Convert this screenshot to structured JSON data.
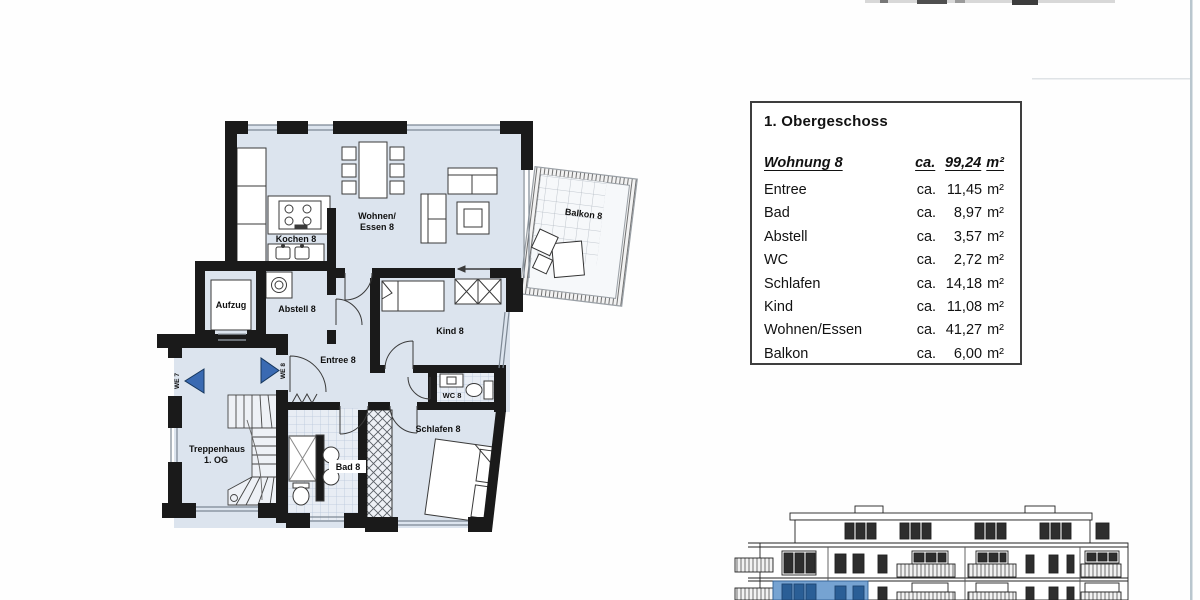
{
  "area_table": {
    "title": "1. Obergeschoss",
    "summary": {
      "label": "Wohnung 8",
      "prefix": "ca.",
      "value": "99,24",
      "unit": "m²"
    },
    "rows": [
      {
        "label": "Entree",
        "prefix": "ca.",
        "value": "11,45",
        "unit": "m²"
      },
      {
        "label": "Bad",
        "prefix": "ca.",
        "value": "8,97",
        "unit": "m²"
      },
      {
        "label": "Abstell",
        "prefix": "ca.",
        "value": "3,57",
        "unit": "m²"
      },
      {
        "label": "WC",
        "prefix": "ca.",
        "value": "2,72",
        "unit": "m²"
      },
      {
        "label": "Schlafen",
        "prefix": "ca.",
        "value": "14,18",
        "unit": "m²"
      },
      {
        "label": "Kind",
        "prefix": "ca.",
        "value": "11,08",
        "unit": "m²"
      },
      {
        "label": "Wohnen/Essen",
        "prefix": "ca.",
        "value": "41,27",
        "unit": "m²"
      },
      {
        "label": "Balkon",
        "prefix": "ca.",
        "value": "6,00",
        "unit": "m²"
      }
    ]
  },
  "floorplan": {
    "labels": {
      "wohnen_line1": "Wohnen/",
      "wohnen_line2": "Essen 8",
      "kochen": "Kochen 8",
      "aufzug": "Aufzug",
      "abstell": "Abstell 8",
      "entree": "Entree 8",
      "kind": "Kind 8",
      "wc": "WC 8",
      "schlafen": "Schlafen 8",
      "bad": "Bad 8",
      "treppenhaus_line1": "Treppenhaus",
      "treppenhaus_line2": "1. OG",
      "balkon": "Balkon 8",
      "we7": "WE 7",
      "we8": "WE 8"
    }
  },
  "colors": {
    "room_fill": "#dce4ee",
    "wall": "#1a1a1a",
    "window_line": "#7d8894",
    "entry_arrow": "#3a6ab2",
    "highlight_unit": "#76a3d2",
    "highlight_window": "#2a5e96",
    "scan_edge_line": "#b9c6ce"
  }
}
